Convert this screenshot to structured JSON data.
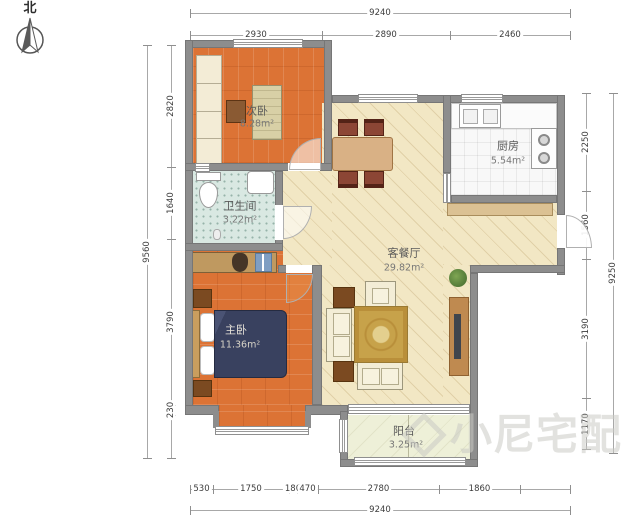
{
  "compass": {
    "label": "北"
  },
  "rooms": [
    {
      "id": "bedroom2",
      "name": "次卧",
      "area": "8.28m²"
    },
    {
      "id": "kitchen",
      "name": "厨房",
      "area": "5.54m²"
    },
    {
      "id": "bathroom",
      "name": "卫生间",
      "area": "3.22m²"
    },
    {
      "id": "living",
      "name": "客餐厅",
      "area": "29.82m²"
    },
    {
      "id": "bedroom1",
      "name": "主卧",
      "area": "11.36m²"
    },
    {
      "id": "balcony",
      "name": "阳台",
      "area": "3.25m²"
    }
  ],
  "dimensions": {
    "top": {
      "overall": "9240",
      "segments": [
        "2930",
        "2890",
        "2460"
      ]
    },
    "left": {
      "overall": "9560",
      "segments": [
        "2820",
        "1640",
        "3790",
        "230",
        ""
      ]
    },
    "right": {
      "overall": "9250",
      "segments": [
        "2250",
        "1560",
        "3190",
        "1170"
      ]
    },
    "bottom": {
      "overall": "9240",
      "segments": [
        "530",
        "1750",
        "180",
        "470",
        "2780",
        "1860",
        ""
      ]
    }
  },
  "watermark": {
    "text": "小尼宅配"
  },
  "colors": {
    "wall": "#8d8d8d",
    "wood_floor": "#dc7335",
    "living_floor": "#f2e7c4",
    "bath_floor": "#d9e8e2",
    "balcony_floor": "#eef0d8",
    "bed_blanket": "#39415f",
    "rug": "#c7a24a",
    "sofa": "#f3edd6"
  }
}
